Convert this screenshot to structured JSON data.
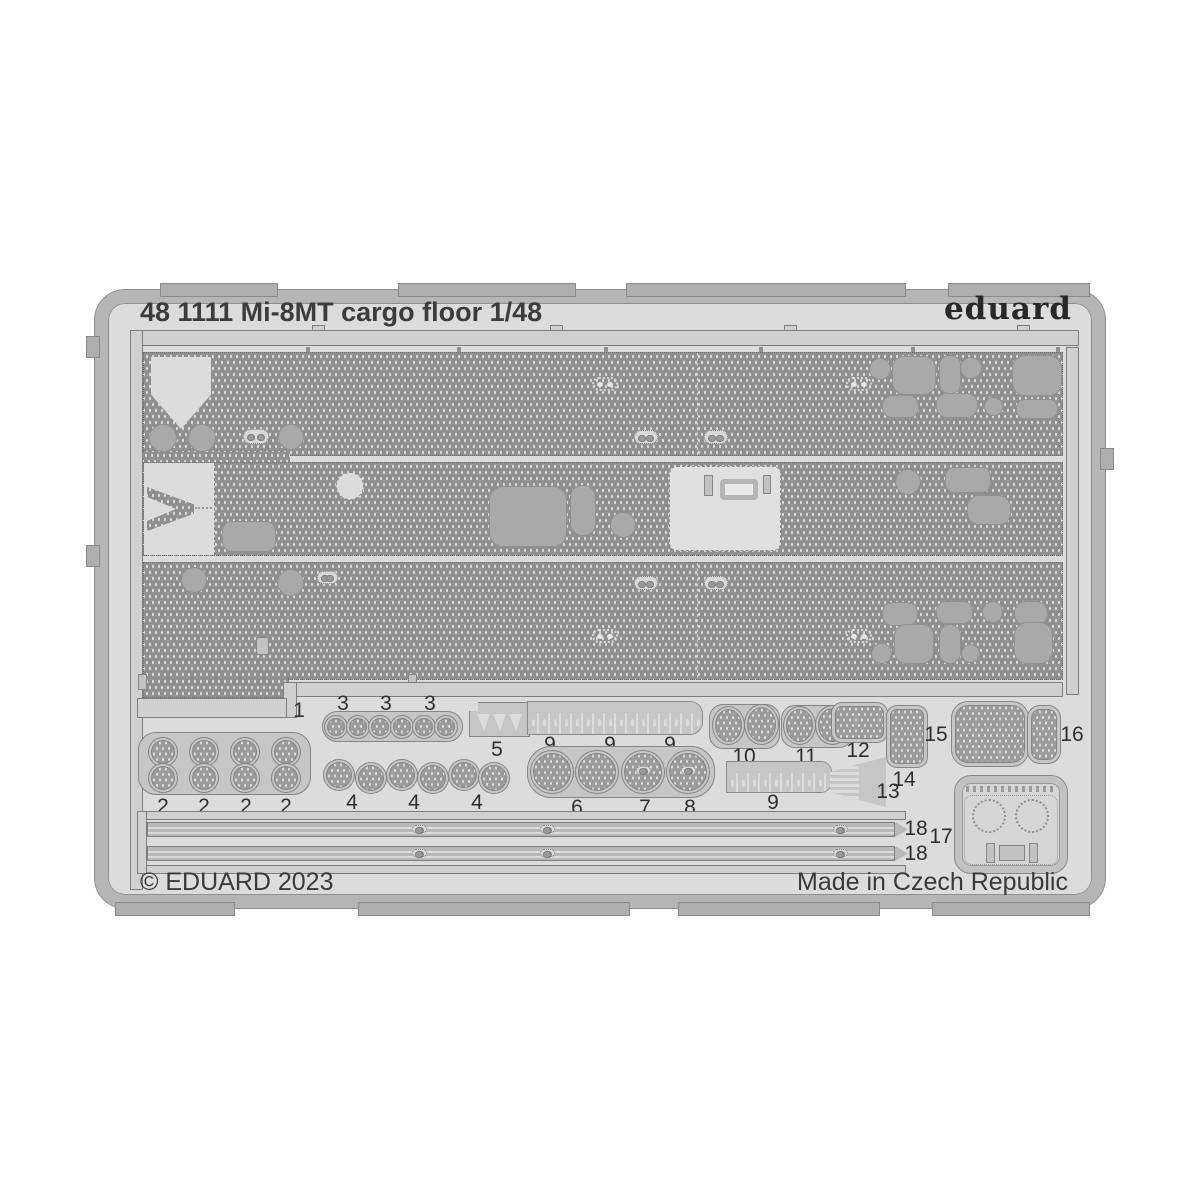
{
  "sheet": {
    "title": "48 1111 Mi-8MT cargo floor 1/48",
    "brand": "eduard",
    "copyright": "© EDUARD 2023",
    "made_in": "Made in Czech Republic"
  },
  "part_labels": {
    "p1": "1",
    "p2": [
      "2",
      "2",
      "2",
      "2"
    ],
    "p3": [
      "3",
      "3",
      "3"
    ],
    "p4": [
      "4",
      "4",
      "4"
    ],
    "p5": "5",
    "p6": "6",
    "p7": "7",
    "p8": "8",
    "p9": [
      "9",
      "9",
      "9",
      "9"
    ],
    "p10": "10",
    "p11": "11",
    "p12": "12",
    "p13": "13",
    "p14": "14",
    "p15": "15",
    "p16": "16",
    "p17": "17",
    "p18": [
      "18",
      "18"
    ]
  },
  "colors": {
    "background": "#ffffff",
    "sheet": "#dcdcdc",
    "frame": "#b6b6b6",
    "texture_base": "#8f8f8f",
    "smooth_spot": "#a9a9a9",
    "carrier": "#c6c6c6",
    "outline": "#7e7e7e",
    "text": "#3c3c3c"
  }
}
